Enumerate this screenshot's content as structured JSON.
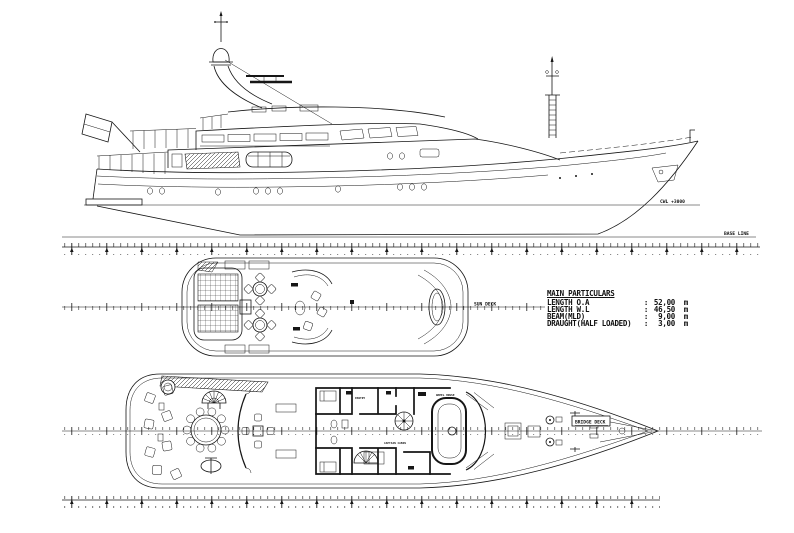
{
  "particulars": {
    "heading": "MAIN PARTICULARS",
    "rows": [
      {
        "label": "LENGTH O.A",
        "colon": ":",
        "value": "52,00",
        "unit": "m"
      },
      {
        "label": "LENGTH W.L",
        "colon": ":",
        "value": "46,50",
        "unit": "m"
      },
      {
        "label": "BEAM(MLD)",
        "colon": ":",
        "value": "9,00",
        "unit": "m"
      },
      {
        "label": "DRAUGHT(HALF LOADED)",
        "colon": ":",
        "value": "3,00",
        "unit": "m"
      }
    ]
  },
  "profile_view": {
    "waterline_label": "CWL +3000",
    "baseline_label": "BASE LINE"
  },
  "sun_deck": {
    "label": "SUN DECK"
  },
  "bridge_deck": {
    "label": "BRIDGE DECK",
    "rooms": {
      "pantry": "PANTRY",
      "captain_cabin": "CAPTAIN CABIN",
      "wheelhouse": "WHEEL HOUSE"
    }
  }
}
